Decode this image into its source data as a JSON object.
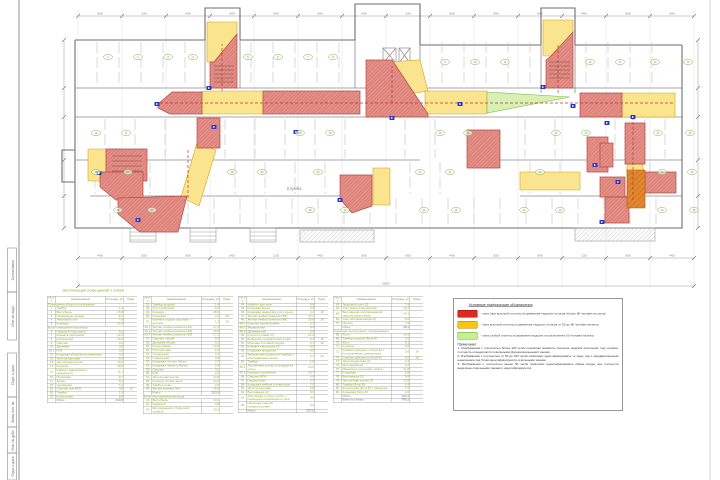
{
  "plan": {
    "flowerbed_label": "Клумба",
    "dim_labels_top": [
      "3600",
      "1200",
      "4400",
      "3000",
      "5400",
      "3000",
      "4400",
      "1200",
      "3600",
      "5400",
      "3000",
      "4400",
      "3600",
      "3000"
    ],
    "dim_labels_bottom": [
      "4400",
      "3000",
      "3600",
      "5400",
      "1200",
      "4400",
      "3000",
      "3600",
      "4400",
      "3000",
      "5400",
      "1200",
      "3600",
      "4400"
    ],
    "dim_total_bottom": "63800",
    "grid_xs": [
      78,
      122,
      166,
      210,
      254,
      298,
      342,
      386,
      430,
      474,
      518,
      562,
      606,
      650,
      694
    ],
    "markers": [
      [
        157,
        104
      ],
      [
        209,
        88
      ],
      [
        99,
        173
      ],
      [
        138,
        220
      ],
      [
        392,
        118
      ],
      [
        543,
        87
      ],
      [
        573,
        106
      ],
      [
        607,
        123
      ],
      [
        595,
        165
      ],
      [
        618,
        182
      ],
      [
        602,
        222
      ],
      [
        633,
        117
      ],
      [
        340,
        200
      ],
      [
        460,
        104
      ],
      [
        214,
        127
      ],
      [
        296,
        132
      ]
    ],
    "room_tags": [
      [
        108,
        57,
        "1"
      ],
      [
        138,
        57,
        "2"
      ],
      [
        168,
        57,
        "3"
      ],
      [
        193,
        57,
        "4"
      ],
      [
        248,
        57,
        "5"
      ],
      [
        278,
        57,
        "6"
      ],
      [
        308,
        57,
        "7"
      ],
      [
        333,
        57,
        "8"
      ],
      [
        445,
        62,
        "9"
      ],
      [
        475,
        62,
        "10"
      ],
      [
        505,
        62,
        "11"
      ],
      [
        590,
        62,
        "12"
      ],
      [
        620,
        62,
        "13"
      ],
      [
        655,
        62,
        "14"
      ],
      [
        688,
        62,
        "15"
      ],
      [
        96,
        133,
        "16"
      ],
      [
        126,
        133,
        "17"
      ],
      [
        300,
        133,
        "18"
      ],
      [
        330,
        133,
        "19"
      ],
      [
        440,
        133,
        "20"
      ],
      [
        468,
        133,
        "21"
      ],
      [
        556,
        133,
        "22"
      ],
      [
        586,
        133,
        "23"
      ],
      [
        658,
        133,
        "24"
      ],
      [
        690,
        133,
        "25"
      ],
      [
        96,
        172,
        "26"
      ],
      [
        128,
        172,
        "27"
      ],
      [
        232,
        172,
        "28"
      ],
      [
        262,
        172,
        "29"
      ],
      [
        318,
        172,
        "30"
      ],
      [
        420,
        172,
        "31"
      ],
      [
        450,
        172,
        "32"
      ],
      [
        540,
        172,
        "33"
      ],
      [
        662,
        172,
        "34"
      ],
      [
        692,
        172,
        "35"
      ],
      [
        118,
        210,
        "36"
      ],
      [
        152,
        210,
        "37"
      ],
      [
        310,
        210,
        "38"
      ],
      [
        345,
        210,
        "39"
      ],
      [
        424,
        210,
        "40"
      ],
      [
        456,
        210,
        "41"
      ],
      [
        524,
        210,
        "42"
      ],
      [
        560,
        210,
        "43"
      ],
      [
        662,
        210,
        "44"
      ],
      [
        694,
        210,
        "45"
      ]
    ]
  },
  "stamps": [
    "Согласовано",
    "Инв. № подл.",
    "Подп. и дата",
    "Взам. инв. №",
    "Инв. № дубл.",
    "Подп. и дата"
  ],
  "schedule": {
    "title": "Экспликация помещений 1 этажа",
    "headers": [
      "№ п/п",
      "Наименование",
      "Площадь, м²",
      "Прим."
    ],
    "tables": [
      {
        "rows": [
          [
            "",
            "Помещения общего пользования",
            "",
            ""
          ],
          [
            "1",
            "Тамбур",
            "1,2",
            ""
          ],
          [
            "2",
            "Вестибюль",
            "15,8",
            ""
          ],
          [
            "3",
            "Помещение охраны",
            "8,4",
            ""
          ],
          [
            "4",
            "Лифтовой холл",
            "7,8",
            ""
          ],
          [
            "5",
            "Коридор",
            "22,6",
            ""
          ],
          [
            "",
            "Блок помещений персонала",
            "",
            ""
          ],
          [
            "6",
            "Гардероб персонала",
            "6,2",
            ""
          ],
          [
            "7",
            "Комната персонала",
            "12,1",
            ""
          ],
          [
            "8",
            "Кухня-ниша",
            "10,4",
            ""
          ],
          [
            "9",
            "Санузел",
            "3,2",
            ""
          ],
          [
            "10",
            "Душевая",
            "3,6",
            ""
          ],
          [
            "10.1",
            "КУИ",
            "2,8",
            ""
          ],
          [
            "11",
            "Кладовая уборочного инвентаря",
            "4,5",
            ""
          ],
          [
            "12",
            "Электрощитовая",
            "6,0",
            ""
          ],
          [
            "13",
            "Лестничная клетка",
            "14,2",
            ""
          ],
          [
            "14",
            "Коридор",
            "18,5",
            ""
          ],
          [
            "15",
            "Кабинет заведующего (дежурного)",
            "11,3",
            ""
          ],
          [
            "16",
            "Приёмная",
            "9,7",
            ""
          ],
          [
            "17",
            "Архив",
            "5,4",
            ""
          ],
          [
            "18",
            "Серверная",
            "6,1",
            ""
          ],
          [
            "19",
            "Санузел для МГН",
            "4,8",
            "16"
          ],
          [
            "20",
            "Тамбур",
            "1,5",
            ""
          ],
          [
            "21",
            "Колясочная",
            "8,9",
            ""
          ],
          [
            "",
            "Итого",
            "219,8",
            ""
          ]
        ]
      },
      {
        "rows": [
          [
            "22",
            "Тамбур входной",
            "1,4",
            ""
          ],
          [
            "23",
            "Холл лифтовой",
            "9,2",
            ""
          ],
          [
            "24",
            "Коридор",
            "28,3",
            ""
          ],
          [
            "25",
            "Кладовая",
            "3,4",
            "16"
          ],
          [
            "26",
            "Комната отдыха (игровая) — детская",
            "1,2",
            "16"
          ],
          [
            "26.1",
            "Жилая ячейка (комната №1)",
            "17,3",
            ""
          ],
          [
            "26.2",
            "Жилая ячейка (комната №2)",
            "16,9",
            ""
          ],
          [
            "26.3",
            "Жилая ячейка (комната №3)",
            "17,1",
            ""
          ],
          [
            "27",
            "Санузел общий",
            "4,6",
            ""
          ],
          [
            "28",
            "Душевая общая",
            "5,2",
            ""
          ],
          [
            "29",
            "Кухня общая",
            "14,8",
            ""
          ],
          [
            "30",
            "Постирочная",
            "6,3",
            ""
          ],
          [
            "31",
            "Сушильная",
            "4,1",
            ""
          ],
          [
            "32",
            "Гладильная",
            "3,9",
            ""
          ],
          [
            "33",
            "Кладовая чистого белья",
            "2,7",
            ""
          ],
          [
            "34",
            "Кладовая грязного белья",
            "2,4",
            ""
          ],
          [
            "35",
            "Санузел",
            "3,1",
            ""
          ],
          [
            "36",
            "КУИ",
            "2,2",
            ""
          ],
          [
            "37",
            "Лестничная клетка",
            "13,8",
            ""
          ],
          [
            "38",
            "Коридор жилой части",
            "19,6",
            ""
          ],
          [
            "39",
            "Тамбур-шлюз",
            "3,4",
            ""
          ],
          [
            "40",
            "Жилая комната №4",
            "16,5",
            ""
          ],
          [
            "",
            "Итого",
            "203,5",
            ""
          ],
          [
            "",
            "Блок обслуживания жильцов",
            "",
            ""
          ],
          [
            "41",
            "Вестибюль",
            "10,2",
            ""
          ],
          [
            "42",
            "Гардероб",
            "4,8",
            ""
          ],
          [
            "43",
            "Зал ожидания с буфетной стойкой",
            "15,4",
            ""
          ]
        ]
      },
      {
        "rows": [
          [
            "44",
            "Кабинет при зале",
            "9,8",
            ""
          ],
          [
            "45",
            "Кладовая белья",
            "3,5",
            ""
          ],
          [
            "46",
            "Кладовая инвентаря для отдыха",
            "4,2",
            "16"
          ],
          [
            "47",
            "Жилая ячейка (комната №5)",
            "17,2",
            ""
          ],
          [
            "48",
            "Жилая ячейка (комната №6)",
            "16,8",
            "16"
          ],
          [
            "48.1",
            "Санузел жилой ячейки",
            "3,3",
            ""
          ],
          [
            "48.2",
            "Умывальная",
            "4,4",
            ""
          ],
          [
            "48.3",
            "Душевая жен.",
            "5,6",
            ""
          ],
          [
            "49",
            "Кухня-столовая (2)",
            "21,4",
            ""
          ],
          [
            "50",
            "Буфетная с раздаточной зоной",
            "8,2",
            "16"
          ],
          [
            "51",
            "Моечная столовой посуды",
            "5,1",
            "16"
          ],
          [
            "52",
            "Комната персонала (2)",
            "9,4",
            ""
          ],
          [
            "53",
            "Кладовая продуктов",
            "4,6",
            ""
          ],
          [
            "54",
            "Загрузочная продуктов (тамбур) с обогреваемым полом",
            "6,3",
            "16"
          ],
          [
            "55",
            "Тамбур",
            "1,8",
            ""
          ],
          [
            "55.1",
            "Лестничная клетка со входом на улицу",
            "14,0",
            ""
          ],
          [
            "55.2",
            "Коридор служебный",
            "23,7",
            ""
          ],
          [
            "56",
            "Санузел МГН",
            "4,9",
            ""
          ],
          [
            "57",
            "Гардеробная",
            "2,3",
            ""
          ],
          [
            "58",
            "Кладовая мебели и инвентаря",
            "7,5",
            ""
          ],
          [
            "59",
            "Электрощитовая",
            "5,8",
            ""
          ],
          [
            "60",
            "Венткамера (2)",
            "9,6",
            ""
          ],
          [
            "61",
            "Узел ввода и учёта тепла — помещение водомерного узла",
            "8,0",
            ""
          ],
          [
            "62",
            "Насосная станция пожаротушения",
            "9,2",
            ""
          ],
          [
            "",
            "Итого",
            "207,6",
            ""
          ]
        ]
      },
      {
        "rows": [
          [
            "63",
            "Лифтовой холл (2)",
            "7,4",
            ""
          ],
          [
            "64",
            "Узел связи и автоматики",
            "10,7",
            ""
          ],
          [
            "65",
            "Венткамера противодымной защиты (приточная)",
            "14,1",
            ""
          ],
          [
            "66",
            "Узел обогрева ввода (2)",
            "8,0",
            ""
          ],
          [
            "67",
            "Проезд",
            "7,9",
            ""
          ],
          [
            "",
            "Итого",
            "48,1",
            ""
          ],
          [
            "",
            "Сквозной проезд (арка), мусорокамера",
            "",
            ""
          ],
          [
            "68",
            "Холл",
            "14,4",
            ""
          ],
          [
            "69",
            "Тамбур входной (блок Б)",
            "1,6",
            ""
          ],
          [
            "70",
            "Холл",
            "9,1",
            ""
          ],
          [
            "71",
            "Коридор",
            "8,6",
            ""
          ],
          [
            "72",
            "Комната дежурного (блок Б) с естественным освещением",
            "2,6",
            "16"
          ],
          [
            "73",
            "Санузел дежурного (блок Б)",
            "3,0",
            "16"
          ],
          [
            "74",
            "Электрощитовая (2)",
            "4,3",
            ""
          ],
          [
            "75",
            "Мусорокамера",
            "5,2",
            ""
          ],
          [
            "76",
            "Машинное отделение лифта",
            "11,8",
            ""
          ],
          [
            "77",
            "Кладовая",
            "3,8",
            ""
          ],
          [
            "78",
            "Венткамера (3)",
            "9,6",
            ""
          ],
          [
            "79",
            "Лестничная клетка Л1",
            "13,9",
            ""
          ],
          [
            "80",
            "Тамбур (блок Б)",
            "1,4",
            ""
          ],
          [
            "81",
            "Колясочная (блок Б) с пандусом",
            "7,2",
            ""
          ],
          [
            "82",
            "Кладовая (блок Б)",
            "2,6",
            ""
          ],
          [
            "",
            "Итого",
            "104,4",
            ""
          ],
          [
            "",
            "Всего по этажу",
            "785,2",
            ""
          ]
        ]
      }
    ]
  },
  "legend": {
    "title": "Условные графические обозначения",
    "items": [
      {
        "fill": "#dd2b1f",
        "border": "#7a1510",
        "text": "- зона (при высокой плотности) движения людских потоков (более 80 человек на метр)"
      },
      {
        "fill": "#fcc40c",
        "border": "#b07d08",
        "text": "- зона высокой плотности движения людских потоков от 50 до 80 человек на метр"
      },
      {
        "fill": "#c7ef92",
        "border": "#67a33c",
        "text": "- зона слабой плотности движения людских потоков менее 50 человек на метр"
      }
    ],
    "notes_title": "Примечания:",
    "notes": [
      "1. Изображения с плотностью более 100 чел/м позволяют выявлять большие людские скопления, под чел/мин; плотность определяется отдельными (функциональными) зонами.",
      "2. Изображения с плотностью от 50 до 100 чел/м позволяют идентифицировать те зоны, где с предварительным нанесением под Точки идентифицируются отдельными зонами.",
      "3. Изображения с плотностью менее 50 чел/м позволяют идентифицировать общие входы; все плотности выделены отдельными зонами и идентифицируются."
    ]
  },
  "colors": {
    "zone_red_fill": "#e59089",
    "zone_red_hatch": "#c4635b",
    "zone_red_border": "#b44a42",
    "zone_yellow_fill": "#fbe48e",
    "zone_yellow_border": "#d2a61a",
    "zone_green_fill": "#d9f0b5",
    "zone_green_border": "#85b84e",
    "zone_orange_fill": "#e2862f",
    "marker_blue": "#2636c8",
    "table_text_green": "#8fae2e"
  }
}
